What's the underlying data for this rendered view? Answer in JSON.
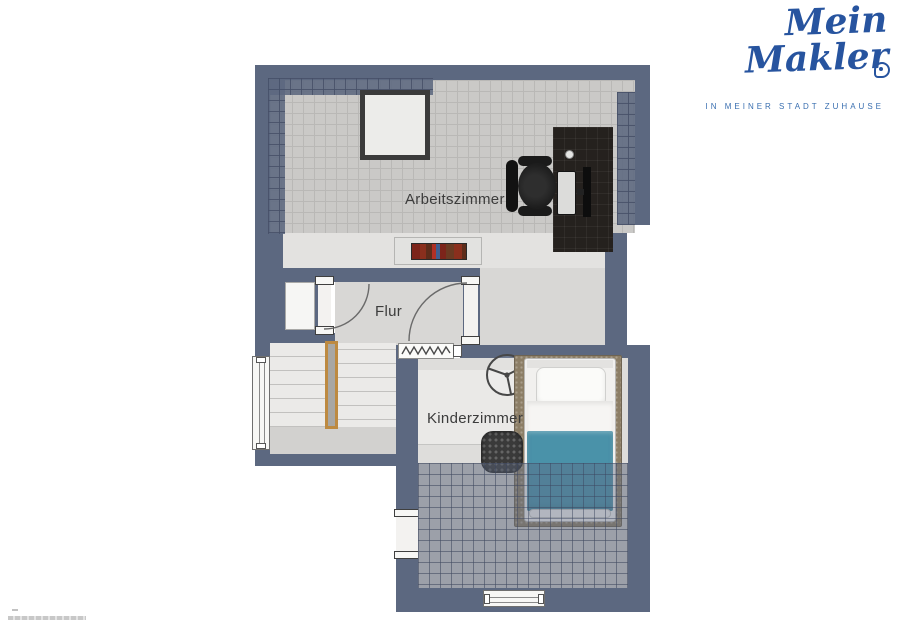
{
  "logo": {
    "brand": "Mein Makler",
    "registered_mark": "®",
    "tagline": "IN MEINER STADT ZUHAUSE",
    "color": "#27549f"
  },
  "rooms": [
    {
      "id": "arbeitszimmer",
      "label": "Arbeitszimmer"
    },
    {
      "id": "flur",
      "label": "Flur"
    },
    {
      "id": "kinderzimmer",
      "label": "Kinderzimmer"
    }
  ],
  "icons": {
    "door_swing": "quarter-arc-door-swing",
    "window": "double-line-window",
    "radiator": "zigzag-radiator",
    "ceiling_fan": "three-blade-fan",
    "stairs": "staircase-with-wood-rail",
    "logo_pin": "location-pin"
  },
  "colors": {
    "wall": "#5c6880",
    "tile_floor": "#cac9c7",
    "light_floor": "#dcdbd9",
    "roof_slope_overlay": "#5c6880",
    "bed_blanket": "#4a92a9",
    "rug": "#8c7e66",
    "stair_rail_wood": "#bd8a41",
    "desk": "#25211e",
    "logo_blue": "#27549f"
  }
}
